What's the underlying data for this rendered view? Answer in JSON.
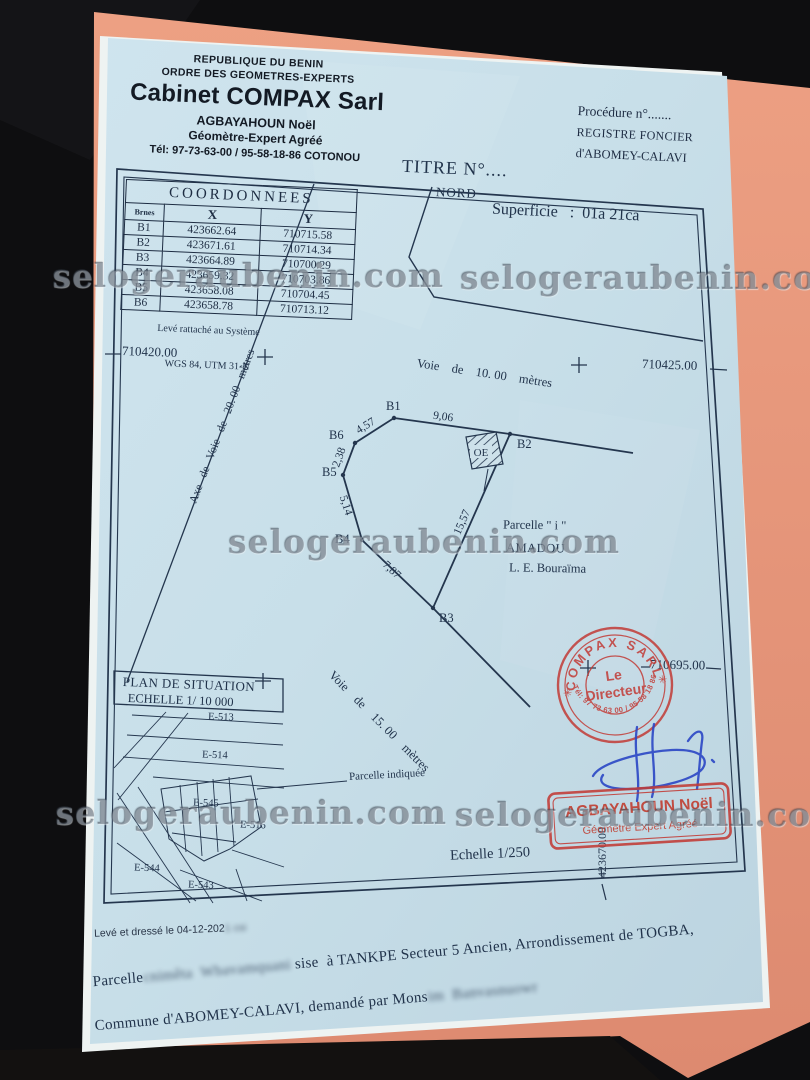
{
  "watermark": {
    "text": "selogeraubenin.com"
  },
  "header": {
    "line1": "REPUBLIQUE DU BENIN",
    "line2": "ORDRE DES GEOMETRES-EXPERTS",
    "firm": "Cabinet COMPAX Sarl",
    "name": "AGBAYAHOUN Noël",
    "role": "Géomètre-Expert Agréé",
    "phone": "Tél: 97-73-63-00 / 95-58-18-86 COTONOU"
  },
  "registry": {
    "procedure": "Procédure n°.......",
    "registre": "REGISTRE FONCIER",
    "city": "d'ABOMEY-CALAVI"
  },
  "title": "TITRE N°....",
  "plan": {
    "nord": "NORD",
    "superficie": "Superficie   :  01a 21ca",
    "voie10": "Voie    de    10. 00    mètres",
    "axe20": "Axe   de   Voie   de   20. 00   mètres",
    "voie15": "Voie    de    15. 00    mètres",
    "echelle": "Echelle 1/250",
    "grid": {
      "left": "710420.00",
      "right": "710425.00",
      "bottom_right": "710695.00",
      "vertical": "423670.00"
    },
    "parcel": {
      "label": "Parcelle \" i \"",
      "owner1": "AMADOU",
      "owner2": "L. E. Bouraïma",
      "oe": "OE",
      "v1": "B1",
      "v2": "B2",
      "v3": "B3",
      "v4": "B4",
      "v5": "B5",
      "v6": "B6",
      "d_b6b1": "4,57",
      "d_b1b2": "9,06",
      "d_b6b5": "2,38",
      "d_b5b4": "5,14",
      "d_b4b3": "7,87",
      "d_b3b2": "15,57"
    }
  },
  "table": {
    "title": "COORDONNEES",
    "col_borne": "Brnes",
    "col_x": "X",
    "col_y": "Y",
    "rows": [
      {
        "id": "B1",
        "x": "423662.64",
        "y": "710715.58"
      },
      {
        "id": "B2",
        "x": "423671.61",
        "y": "710714.34"
      },
      {
        "id": "B3",
        "x": "423664.89",
        "y": "710700.29"
      },
      {
        "id": "B4",
        "x": "423659.32",
        "y": "710703.86"
      },
      {
        "id": "B5",
        "x": "423658.08",
        "y": "710704.45"
      },
      {
        "id": "B6",
        "x": "423658.78",
        "y": "710713.12"
      }
    ],
    "note1": "Levé rattaché au Système",
    "note2": "WGS 84, UTM 31-N"
  },
  "situation": {
    "title": "PLAN DE SITUATION",
    "scale": "ECHELLE 1/ 10 000",
    "pointer": "Parcelle indiquée",
    "lot1": "E-513",
    "lot2": "E-514",
    "lot3": "E-545",
    "lot4": "E-516",
    "lot5": "E-544",
    "lot6": "E-543"
  },
  "stamps": {
    "round": {
      "top": "COMPAX SARL",
      "center1": "Le",
      "center2": "Directeur",
      "bottom": "Tél: 97 73 63 00 / 95 58 18 86",
      "star": "✳"
    },
    "rect": {
      "name": "AGBAYAHOUN Noël",
      "role": "Géomètre Expert Agréé"
    }
  },
  "footer": {
    "line0": "Levé et dressé le 04-12-202",
    "line0_redacted": "1 csi",
    "line1_prefix": "Parcelle",
    "line1_redacted": "cnimêta  Wbavamquani",
    "line1_suffix": "sise  à TANKPE Secteur 5 Ancien, Arrondissement de TOGBA,",
    "line2_prefix": "Commune d'ABOMEY-CALAVI, demandé par Mons",
    "line2_redacted": "im  Banvasnuowr"
  }
}
